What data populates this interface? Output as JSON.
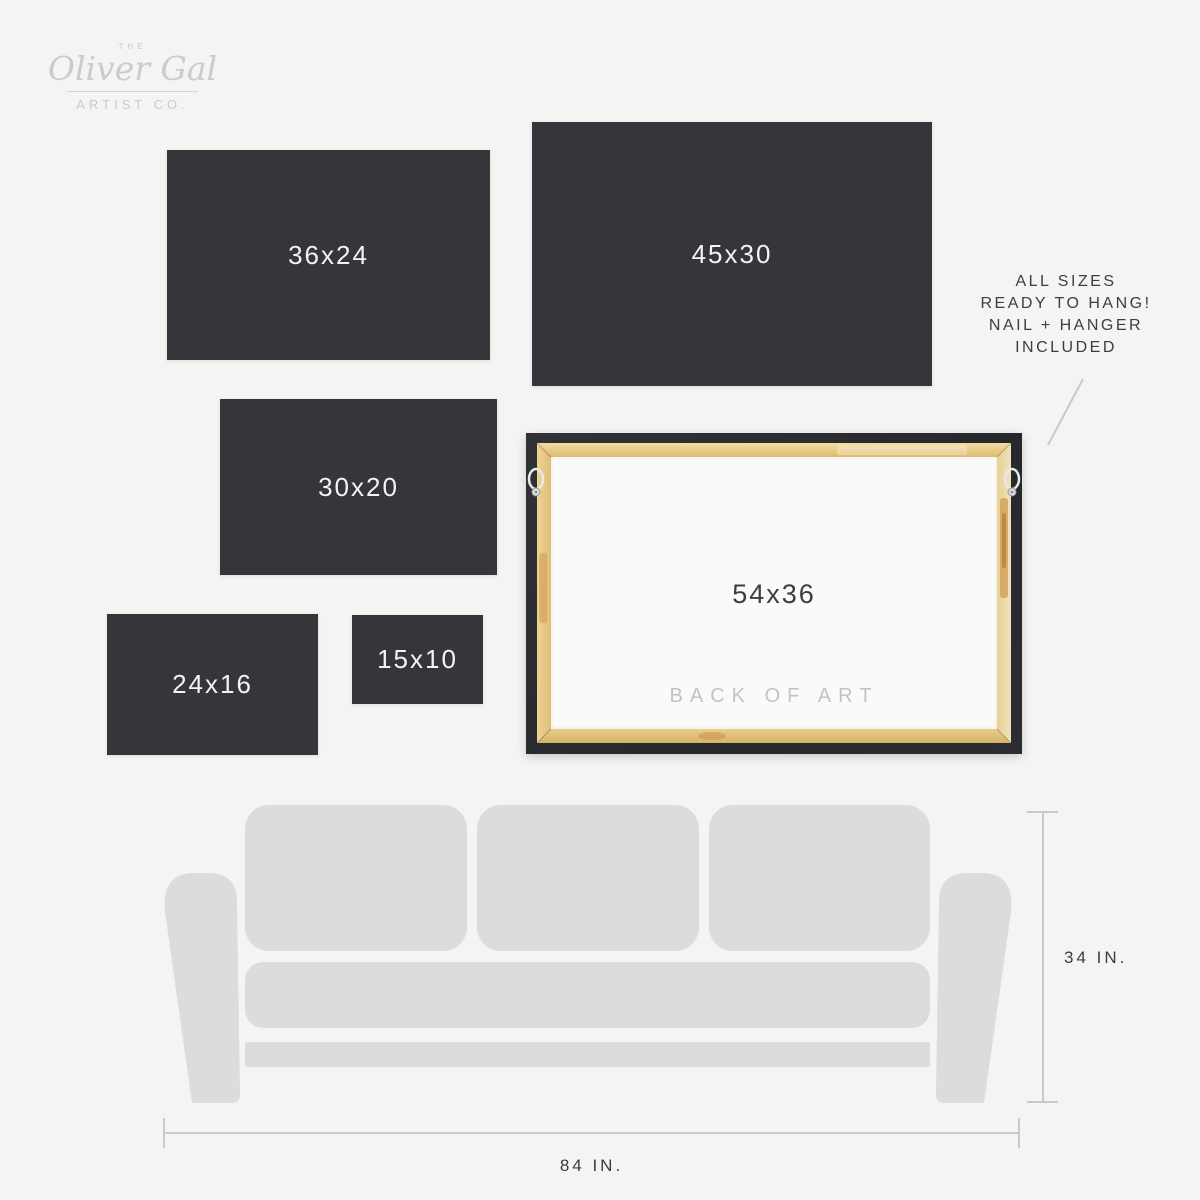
{
  "logo": {
    "the": "THE",
    "name": "Oliver Gal",
    "suffix": "ARTIST CO."
  },
  "size_swatches": [
    {
      "label": "36x24",
      "x": 167,
      "y": 150,
      "w": 323,
      "h": 210
    },
    {
      "label": "45x30",
      "x": 532,
      "y": 122,
      "w": 400,
      "h": 264
    },
    {
      "label": "30x20",
      "x": 220,
      "y": 399,
      "w": 277,
      "h": 176
    },
    {
      "label": "24x16",
      "x": 107,
      "y": 614,
      "w": 211,
      "h": 141
    },
    {
      "label": "15x10",
      "x": 352,
      "y": 615,
      "w": 131,
      "h": 89
    }
  ],
  "note": {
    "lines": [
      "ALL SIZES",
      "READY TO HANG!",
      "NAIL + HANGER",
      "INCLUDED"
    ]
  },
  "frame": {
    "label": "54x36",
    "caption": "BACK OF ART"
  },
  "sofa": {
    "height_label": "34 IN.",
    "width_label": "84 IN."
  },
  "colors": {
    "background": "#f4f4f2",
    "swatch": "#343639",
    "swatch_text": "#f3f3f3",
    "frame_border": "#27292d",
    "wood_light": "#f0d99f",
    "wood_dark": "#ddb76c",
    "canvas": "#fafaf9",
    "caption_gray": "#c3c3c3",
    "sofa_gray": "#dcdcdb",
    "measure_line": "#c9c9c9",
    "text_dark": "#3d3d3d",
    "logo_gray": "#cbcbcb"
  }
}
